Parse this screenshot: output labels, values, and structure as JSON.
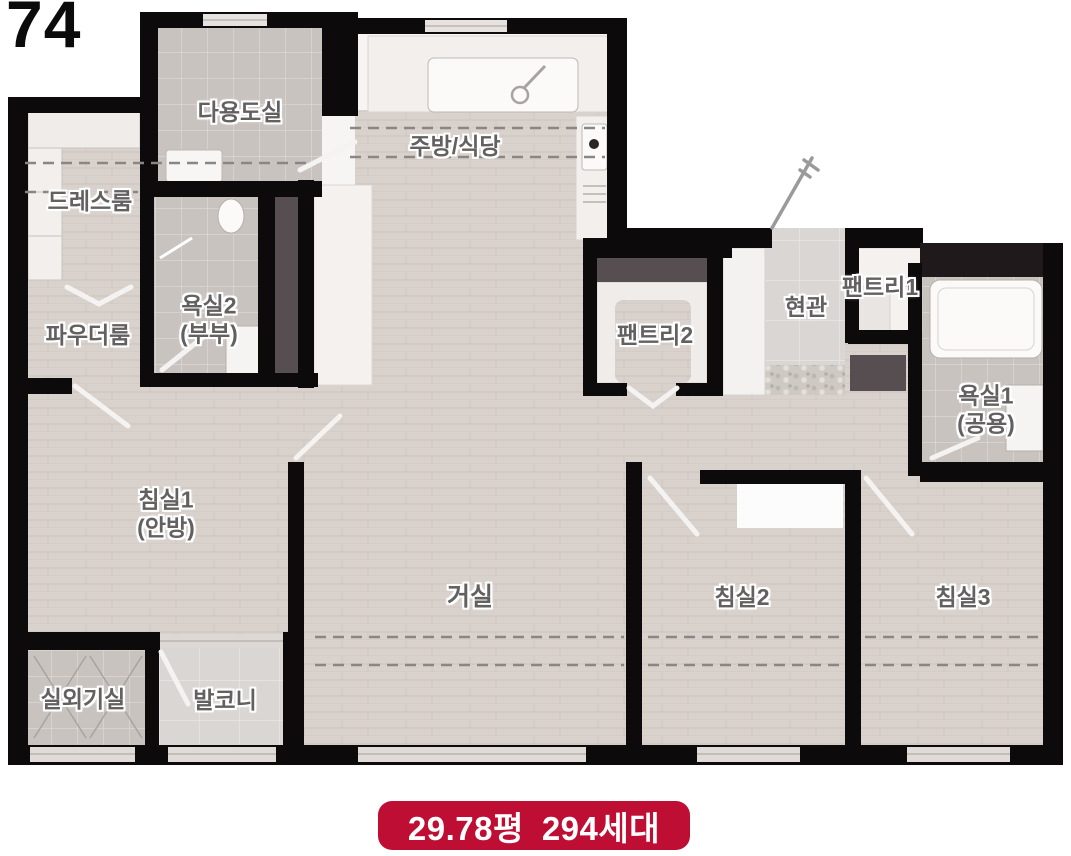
{
  "unit": {
    "number": "74"
  },
  "badge": {
    "area": "29.78평",
    "households": "294세대",
    "bg_color": "#bf0e33",
    "text_color": "#ffffff"
  },
  "rooms": {
    "utility": {
      "label": "다용도실"
    },
    "kitchen": {
      "label": "주방/식당"
    },
    "dressroom": {
      "label": "드레스룸"
    },
    "bath2": {
      "label": "욕실2",
      "sublabel": "(부부)"
    },
    "powder": {
      "label": "파우더룸"
    },
    "pantry2": {
      "label": "팬트리2"
    },
    "entrance": {
      "label": "현관"
    },
    "pantry1": {
      "label": "팬트리1"
    },
    "bath1": {
      "label": "욕실1",
      "sublabel": "(공용)"
    },
    "bedroom1": {
      "label": "침실1",
      "sublabel": "(안방)"
    },
    "living": {
      "label": "거실"
    },
    "bedroom2": {
      "label": "침실2"
    },
    "bedroom3": {
      "label": "침실3"
    },
    "ac_room": {
      "label": "실외기실"
    },
    "balcony": {
      "label": "발코니"
    }
  },
  "colors": {
    "wall": "#0d0a0b",
    "wood_floor": "#d9d1cc",
    "tile_floor": "#c9c3c0",
    "wardrobe_dark": "#574e51",
    "accent_red": "#bf0e33",
    "label_text": "#636060"
  }
}
